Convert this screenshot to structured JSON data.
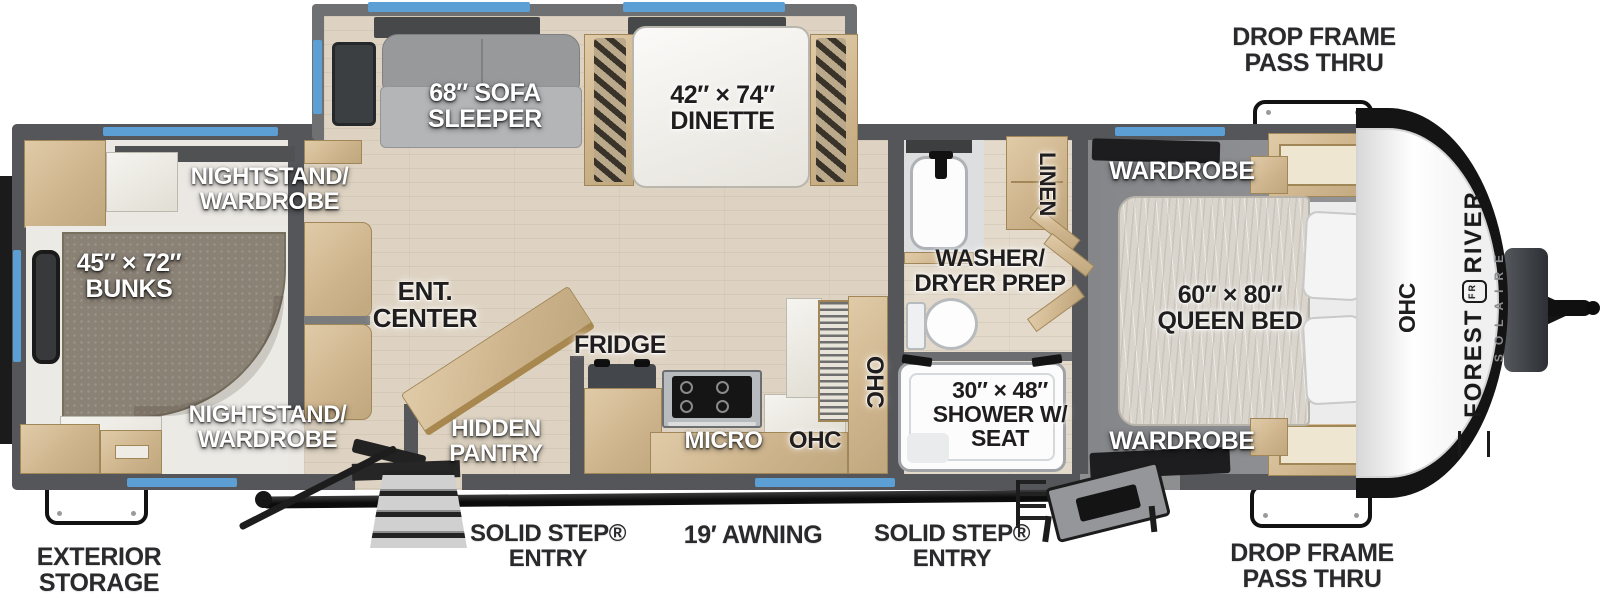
{
  "title": "Forest River Solaire travel trailer floor plan",
  "brand": {
    "word1": "FOREST",
    "word2": "RIVER",
    "monogram": "FR",
    "sub": "SOLAIRE"
  },
  "colors": {
    "wall": "#55565a",
    "window_blue": "#5b9fd4",
    "wood": "#d2bb94",
    "floor_wood": "#ded3c2",
    "carpet": "#8e8f91",
    "accent_black": "#1d1d1f"
  },
  "exterior": {
    "drop_frame_top": {
      "line1": "DROP FRAME",
      "line2": "PASS THRU"
    },
    "drop_frame_bottom": {
      "line1": "DROP FRAME",
      "line2": "PASS THRU"
    },
    "exterior_storage": {
      "line1": "EXTERIOR",
      "line2": "STORAGE"
    },
    "entry_front": {
      "line1": "SOLID STEP®",
      "line2": "ENTRY"
    },
    "entry_rear": {
      "line1": "SOLID STEP®",
      "line2": "ENTRY"
    },
    "awning": {
      "line1": "19′ AWNING"
    }
  },
  "slideout": {
    "sofa": {
      "line1": "68″ SOFA",
      "line2": "SLEEPER"
    },
    "dinette": {
      "line1": "42″ × 74″",
      "line2": "DINETTE"
    }
  },
  "bunk_room": {
    "nightstand_top": {
      "line1": "NIGHTSTAND/",
      "line2": "WARDROBE"
    },
    "bunks": {
      "line1": "45″ × 72″",
      "line2": "BUNKS"
    },
    "nightstand_bottom": {
      "line1": "NIGHTSTAND/",
      "line2": "WARDROBE"
    }
  },
  "living": {
    "ent_center": {
      "line1": "ENT.",
      "line2": "CENTER"
    },
    "hidden_pantry": {
      "line1": "HIDDEN",
      "line2": "PANTRY"
    },
    "fridge": "FRIDGE",
    "micro": "MICRO",
    "ohc_lower": "OHC",
    "ohc_counter": "OHC"
  },
  "bath": {
    "washer_dryer": {
      "line1": "WASHER/",
      "line2": "DRYER PREP"
    },
    "linen": "LINEN",
    "shower": {
      "line1": "30″ × 48″",
      "line2": "SHOWER W/",
      "line3": "SEAT"
    }
  },
  "bedroom": {
    "wardrobe_top": "WARDROBE",
    "wardrobe_bottom": "WARDROBE",
    "queen_bed": {
      "line1": "60″ × 80″",
      "line2": "QUEEN BED"
    },
    "ohc": "OHC"
  }
}
